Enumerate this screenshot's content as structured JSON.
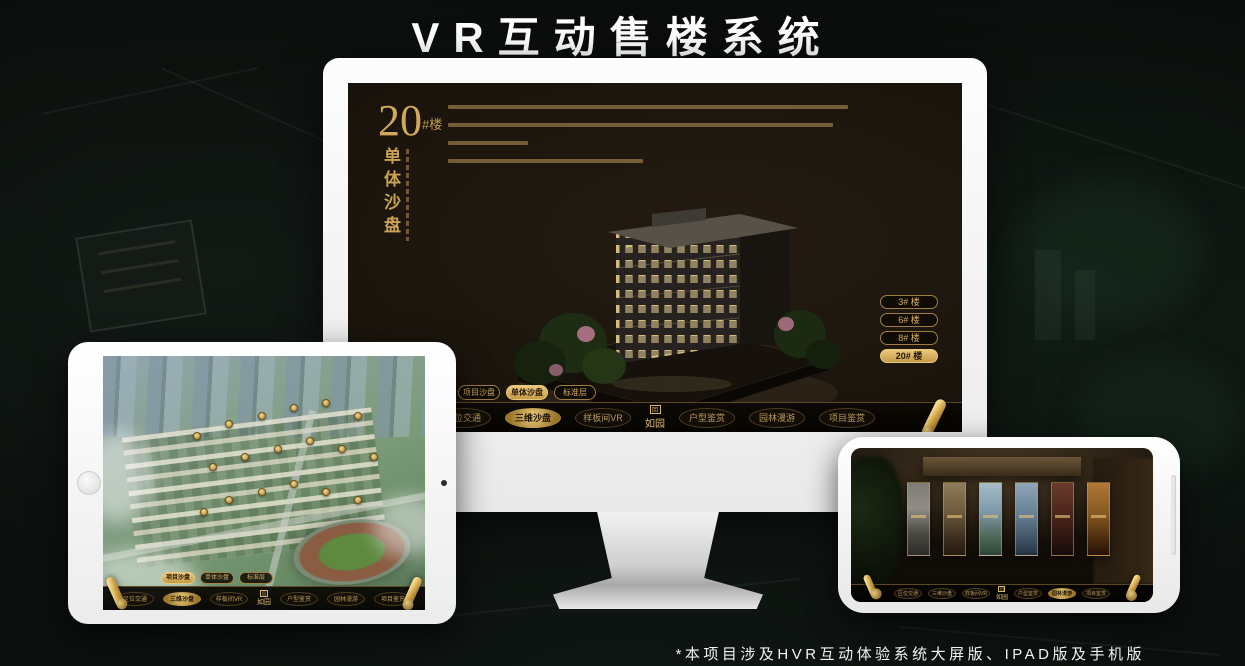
{
  "page": {
    "title": "VR互动售楼系统",
    "footnote": "*本项目涉及HVR互动体验系统大屏版、IPAD版及手机版"
  },
  "nav": {
    "logo": "如园",
    "logo_emblem": "回",
    "items": [
      {
        "label": "区位交通"
      },
      {
        "label": "三维沙盘"
      },
      {
        "label": "样板间VR"
      },
      {
        "label": "户型鉴赏"
      },
      {
        "label": "园林漫游"
      },
      {
        "label": "项目鉴赏"
      }
    ]
  },
  "tabs": [
    {
      "label": "项目沙盘"
    },
    {
      "label": "单体沙盘"
    },
    {
      "label": "标准层"
    }
  ],
  "desktop": {
    "headline": {
      "number": "20",
      "suffix": "#楼",
      "subtitle": "单体沙盘"
    },
    "buildings": [
      {
        "label": "3# 楼",
        "active": false
      },
      {
        "label": "6# 楼",
        "active": false
      },
      {
        "label": "8# 楼",
        "active": false
      },
      {
        "label": "20# 楼",
        "active": true
      }
    ]
  },
  "colors": {
    "gold": "#c9a254",
    "gold_bright": "#ecc97c",
    "screen_bg": "#171007",
    "page_bg": "#0b100d"
  }
}
